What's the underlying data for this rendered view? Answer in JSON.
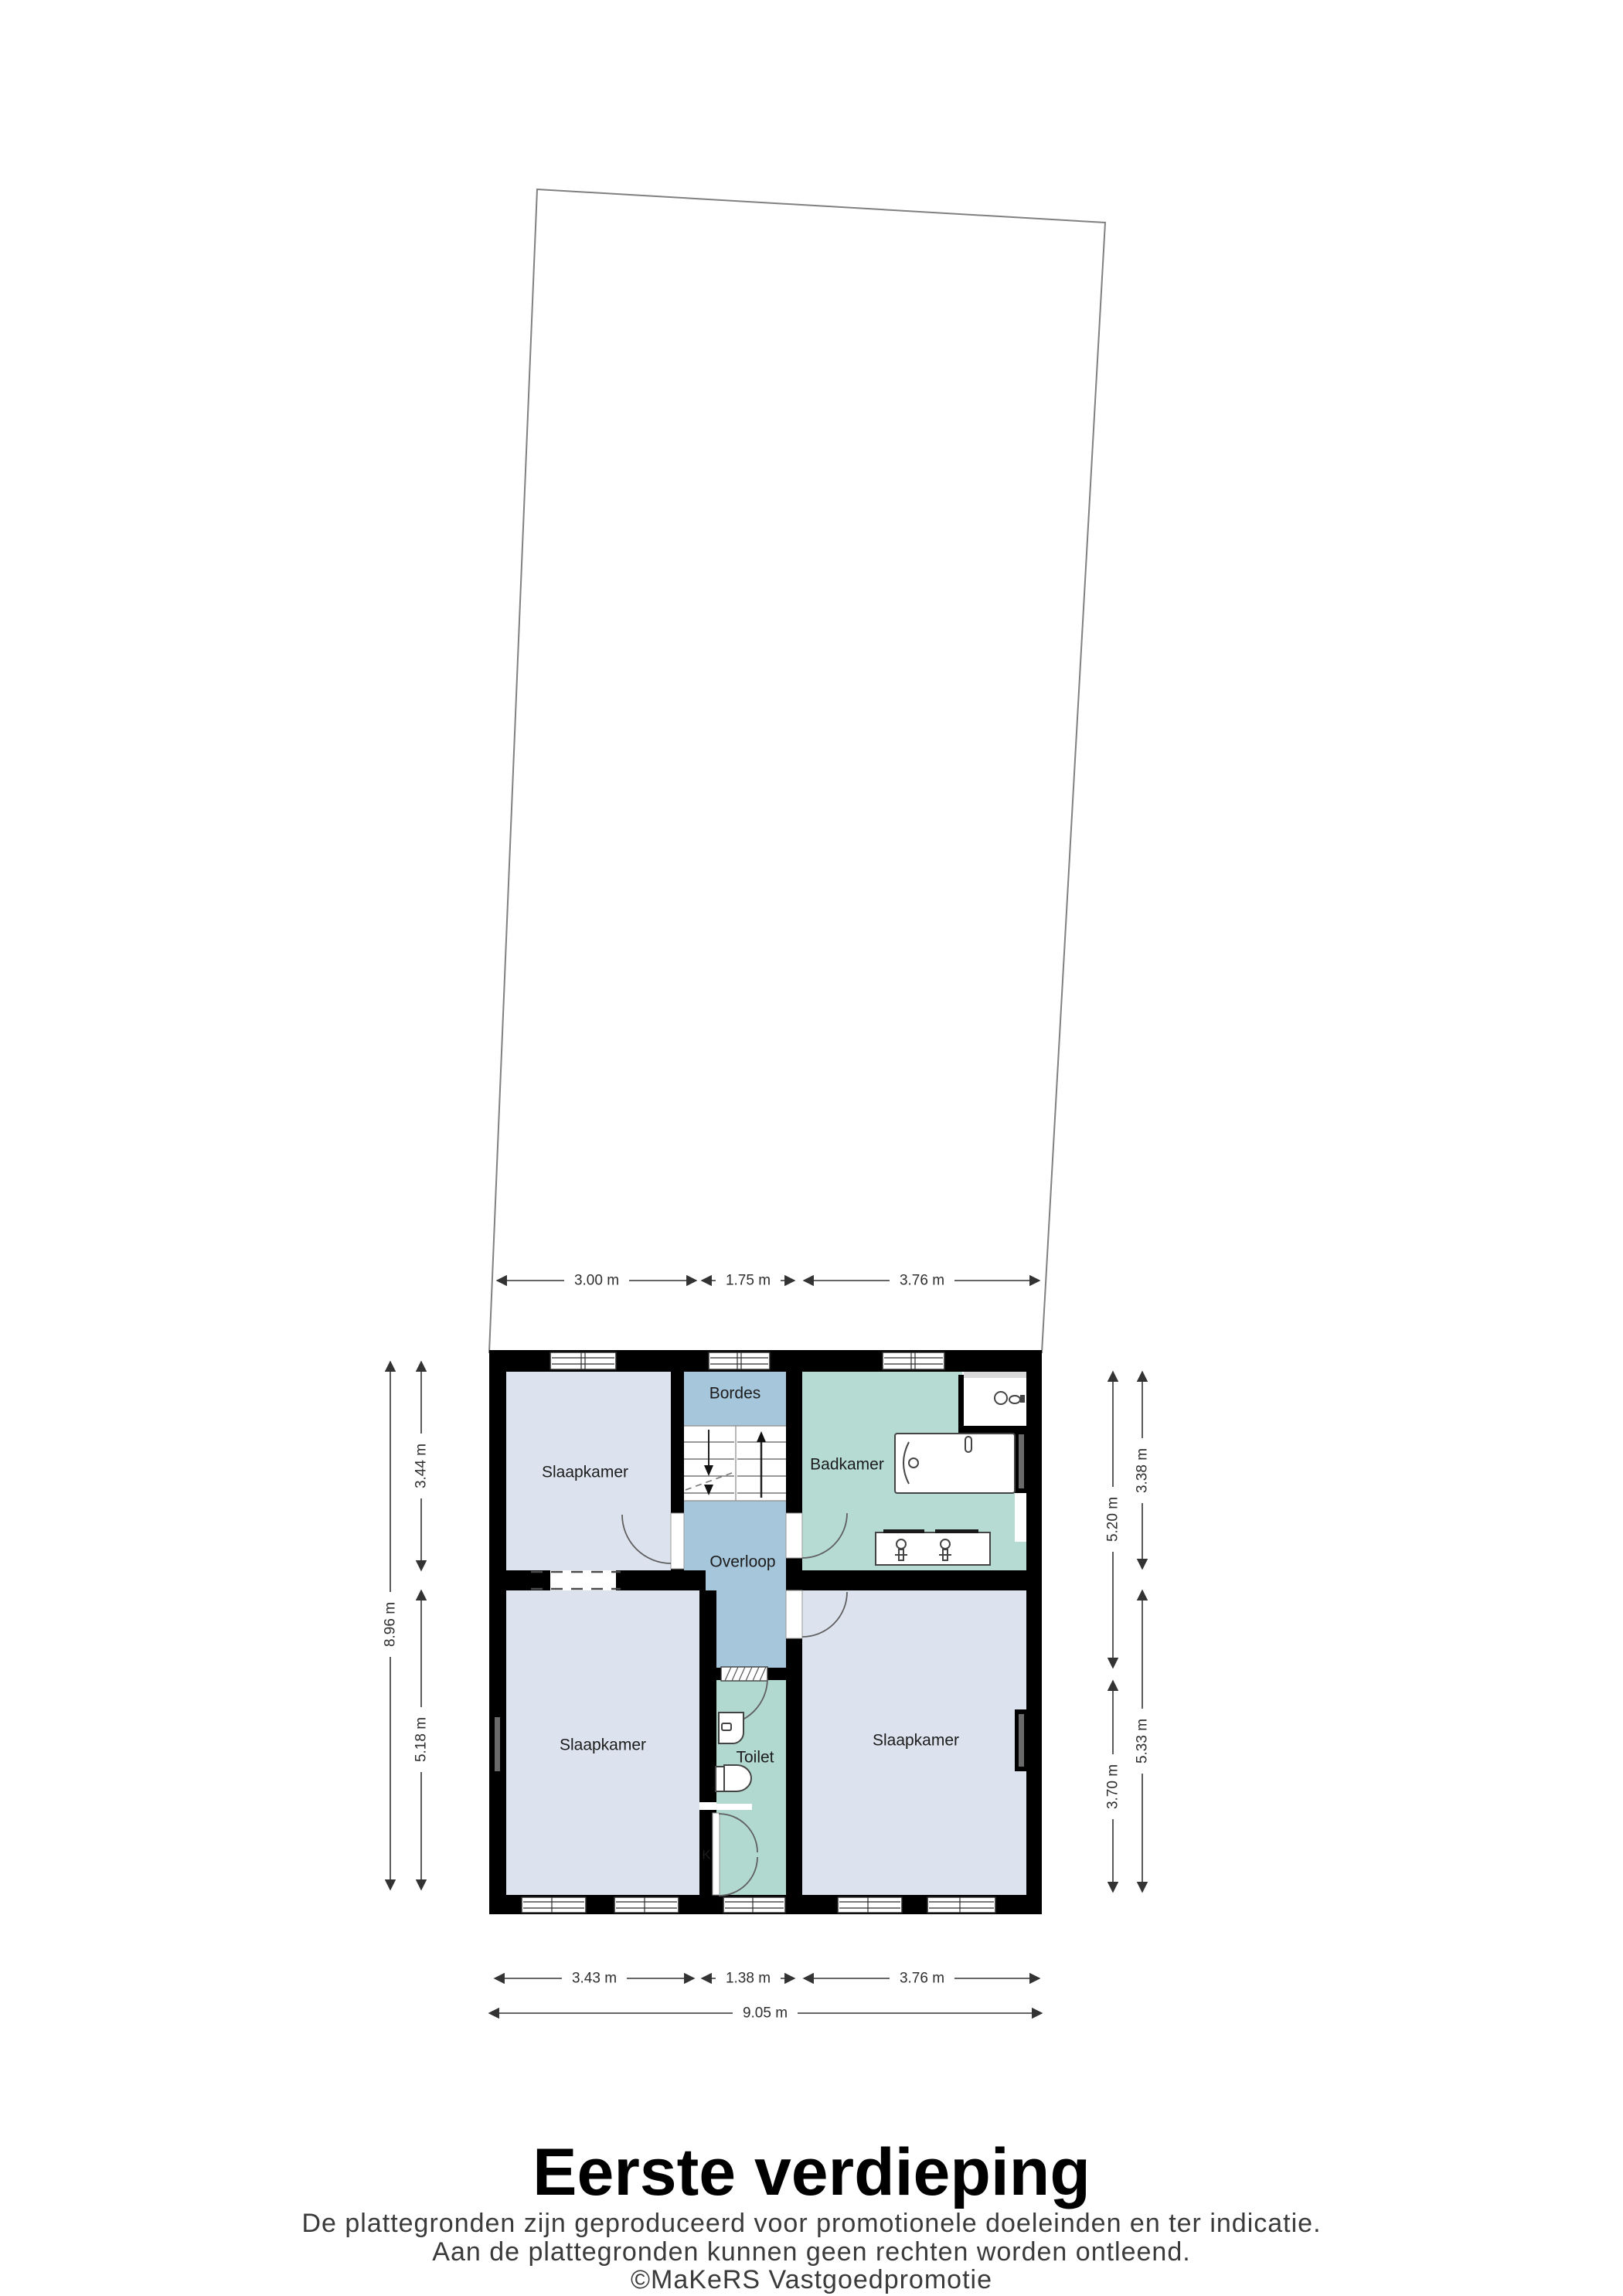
{
  "floorplan": {
    "title": "Eerste verdieping",
    "disclaimer": [
      "De plattegronden zijn geproduceerd voor promotionele doeleinden en ter indicatie.",
      "Aan de plattegronden kunnen geen rechten worden ontleend.",
      "©MaKeRS Vastgoedpromotie"
    ],
    "rooms": {
      "bedroom_top_left": "Slaapkamer",
      "bedroom_bottom_left": "Slaapkamer",
      "bedroom_right": "Slaapkamer",
      "bathroom": "Badkamer",
      "upper_landing": "Bordes",
      "landing": "Overloop",
      "toilet": "Toilet",
      "closet": "K"
    },
    "dimensions": {
      "top": [
        "3.00 m",
        "1.75 m",
        "3.76 m"
      ],
      "bottom": [
        "3.43 m",
        "1.38 m",
        "3.76 m"
      ],
      "bottom_total": "9.05 m",
      "left_inner": [
        "3.44 m",
        "5.18 m"
      ],
      "left_total": "8.96 m",
      "right_inner": [
        "5.20 m",
        "3.70 m"
      ],
      "right_outer": [
        "3.38 m",
        "5.33 m"
      ]
    },
    "colors": {
      "wall": "#000000",
      "bedroom_fill": "#dde3ee",
      "hall_fill": "#a6c6db",
      "bath_fill": "#b5dbd2",
      "toilet_fill": "#b2d9cf",
      "plot_line": "#808080"
    }
  }
}
